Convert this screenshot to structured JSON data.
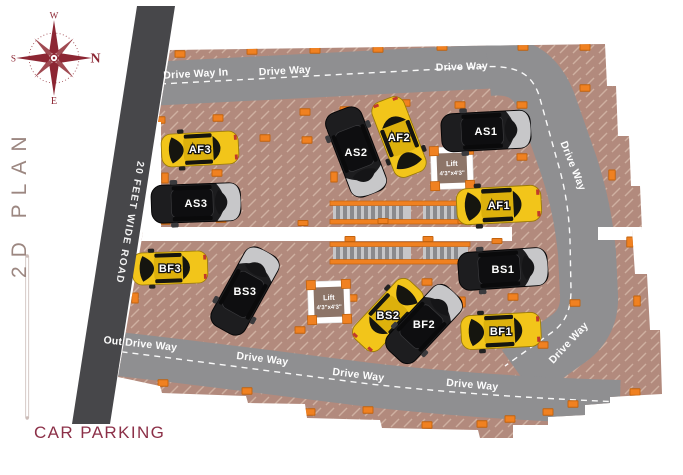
{
  "titles": {
    "plan": "2D PLAN",
    "caption": "CAR PARKING"
  },
  "compass": {
    "top": "W",
    "right": "N",
    "bottom": "E",
    "left": "S"
  },
  "road": {
    "label": "20 FEET WIDE ROAD"
  },
  "driveway_labels": [
    {
      "text": "Drive Way In",
      "x": 196,
      "y": 77,
      "rot": -3
    },
    {
      "text": "Drive Way",
      "x": 285,
      "y": 74,
      "rot": -3
    },
    {
      "text": "Drive Way",
      "x": 462,
      "y": 70,
      "rot": -2
    },
    {
      "text": "Drive Way",
      "x": 570,
      "y": 167,
      "rot": 68
    },
    {
      "text": "Drive Way",
      "x": 571,
      "y": 345,
      "rot": -47
    },
    {
      "text": "Out Drive Way",
      "x": 140,
      "y": 347,
      "rot": 6
    },
    {
      "text": "Drive Way",
      "x": 262,
      "y": 362,
      "rot": 7
    },
    {
      "text": "Drive Way",
      "x": 358,
      "y": 378,
      "rot": 7
    },
    {
      "text": "Drive Way",
      "x": 472,
      "y": 388,
      "rot": 5
    }
  ],
  "lifts": [
    {
      "label": "Lift",
      "size": "4'3\"x4'3\"",
      "x": 452,
      "y": 168
    },
    {
      "label": "Lift",
      "size": "4'3\"x4'3\"",
      "x": 329,
      "y": 302
    }
  ],
  "cars": [
    {
      "id": "AF3",
      "color": "yellow",
      "x": 200,
      "y": 149,
      "rot": -3,
      "scale": 0.82,
      "flip": false
    },
    {
      "id": "AS3",
      "color": "black",
      "x": 196,
      "y": 203,
      "rot": -2,
      "scale": 0.95,
      "flip": false
    },
    {
      "id": "AS2",
      "color": "black",
      "x": 356,
      "y": 152,
      "rot": 69,
      "scale": 0.95,
      "flip": false
    },
    {
      "id": "AF2",
      "color": "yellow",
      "x": 399,
      "y": 137,
      "rot": 69,
      "scale": 0.85,
      "flip": true
    },
    {
      "id": "AS1",
      "color": "black",
      "x": 486,
      "y": 131,
      "rot": -3,
      "scale": 0.95,
      "flip": false
    },
    {
      "id": "AF1",
      "color": "yellow",
      "x": 499,
      "y": 205,
      "rot": -3,
      "scale": 0.9,
      "flip": false
    },
    {
      "id": "BF3",
      "color": "yellow",
      "x": 170,
      "y": 268,
      "rot": -2,
      "scale": 0.8,
      "flip": false
    },
    {
      "id": "BS3",
      "color": "black",
      "x": 245,
      "y": 291,
      "rot": -61,
      "scale": 0.95,
      "flip": false
    },
    {
      "id": "BS2",
      "color": "yellow",
      "x": 388,
      "y": 315,
      "rot": -47,
      "scale": 0.85,
      "flip": true
    },
    {
      "id": "BF2",
      "color": "black",
      "x": 424,
      "y": 324,
      "rot": -47,
      "scale": 0.92,
      "flip": false
    },
    {
      "id": "BS1",
      "color": "black",
      "x": 503,
      "y": 269,
      "rot": -4,
      "scale": 0.95,
      "flip": false
    },
    {
      "id": "BF1",
      "color": "yellow",
      "x": 501,
      "y": 331,
      "rot": -3,
      "scale": 0.85,
      "flip": false
    }
  ],
  "markers": [
    [
      180,
      54
    ],
    [
      252,
      51
    ],
    [
      315,
      50
    ],
    [
      378,
      49
    ],
    [
      442,
      47
    ],
    [
      523,
      47
    ],
    [
      585,
      47
    ],
    [
      160,
      120
    ],
    [
      218,
      118
    ],
    [
      305,
      112
    ],
    [
      345,
      110
    ],
    [
      405,
      103
    ],
    [
      460,
      105
    ],
    [
      522,
      105
    ],
    [
      265,
      138
    ],
    [
      307,
      140
    ],
    [
      334,
      177,
      1
    ],
    [
      585,
      88
    ],
    [
      522,
      157
    ],
    [
      612,
      175,
      1
    ],
    [
      165,
      178,
      1
    ],
    [
      217,
      173
    ],
    [
      165,
      221
    ],
    [
      221,
      219
    ],
    [
      630,
      242,
      1
    ],
    [
      135,
      298,
      1
    ],
    [
      300,
      330
    ],
    [
      352,
      298
    ],
    [
      427,
      282
    ],
    [
      462,
      302,
      1
    ],
    [
      513,
      297
    ],
    [
      543,
      345
    ],
    [
      575,
      303
    ],
    [
      637,
      301,
      1
    ],
    [
      163,
      383
    ],
    [
      247,
      391
    ],
    [
      310,
      412
    ],
    [
      368,
      410
    ],
    [
      427,
      425
    ],
    [
      482,
      424
    ],
    [
      510,
      419
    ],
    [
      548,
      412
    ],
    [
      573,
      404
    ],
    [
      635,
      392
    ]
  ],
  "joint_ticks": [
    [
      303,
      223
    ],
    [
      383,
      221
    ],
    [
      463,
      221
    ],
    [
      110,
      240
    ],
    [
      350,
      239
    ],
    [
      428,
      239
    ],
    [
      497,
      241
    ]
  ],
  "colors": {
    "brick": "#b28a7d",
    "brick_line": "#cfb0a1",
    "driveway": "#8f8f91",
    "road": "#47474a",
    "marker": "#f08121",
    "marker_edge": "#c2620d",
    "dash": "#ffffff",
    "car_yellow": "#f2c51a",
    "car_black": "#1d1d1f",
    "car_silver": "#c7c7c9",
    "lift_fill": "#8d7568",
    "stair_bg": "#c6c6c8",
    "stair_stripe": "#8a8a8d",
    "compass_red": "#8c2633",
    "title": "#9c8781",
    "caption": "#8c3048"
  }
}
